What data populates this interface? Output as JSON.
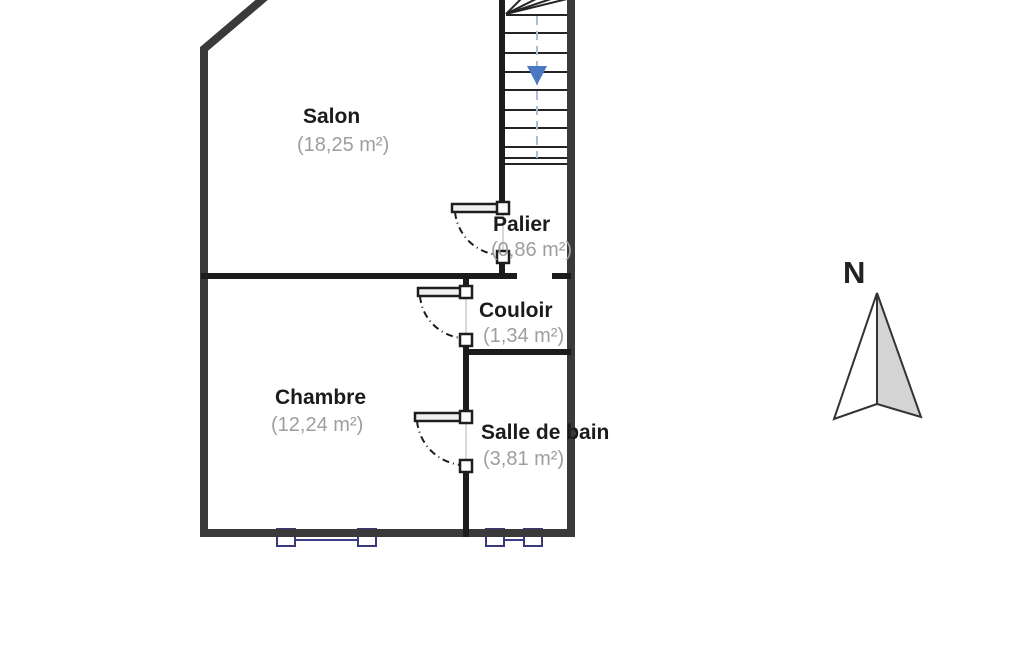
{
  "plan": {
    "rooms": [
      {
        "name": "Salon",
        "area": "(18,25 m²)"
      },
      {
        "name": "Palier",
        "area": "(0,86 m²)"
      },
      {
        "name": "Couloir",
        "area": "(1,34 m²)"
      },
      {
        "name": "Chambre",
        "area": "(12,24 m²)"
      },
      {
        "name": "Salle de bain",
        "area": "(3,81 m²)"
      }
    ],
    "compass": {
      "label": "N"
    }
  },
  "colors": {
    "exterior_wall": "#3a3a3a",
    "interior_wall": "#1c1c1c",
    "window": "#3d3d8f",
    "stair_arrow": "#4b78c3",
    "stair_guide": "#aabcd9",
    "room_name_text": "#1b1b1b",
    "room_area_text": "#9e9e9e",
    "compass_fill": "#d4d4d4"
  }
}
